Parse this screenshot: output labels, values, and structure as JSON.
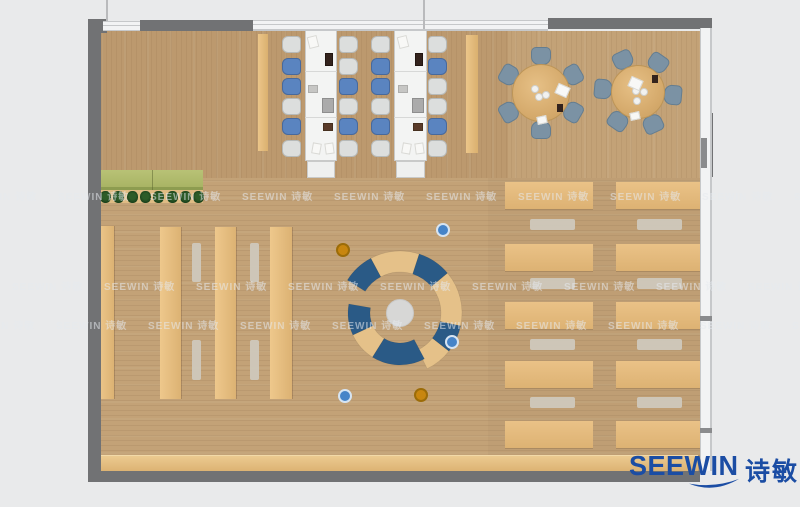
{
  "logo": {
    "en": "SEEWIN",
    "cn": "诗敏",
    "color": "#1b4da4"
  },
  "watermark": {
    "text": "SEEWIN 诗敏",
    "color": "rgba(230,233,238,0.55)",
    "step": 92,
    "rows": [
      {
        "y": 188,
        "x0": -34
      },
      {
        "y": 278,
        "x0": 12
      },
      {
        "y": 317,
        "x0": -36
      }
    ]
  },
  "palette": {
    "bg": "#e9eaeb",
    "wall": "#717274",
    "window": "#f2f3f4",
    "windowLine": "#c6c8ca",
    "floor": "#c3a277",
    "tanLight": "#eec88c",
    "tanDark": "#dcb273",
    "benchGray": "rgba(207,200,188,0.95)",
    "chairBlue": "#5a84c0",
    "chairBlueEdge": "#47699d",
    "chairGray": "#dcdedd",
    "chairGrayEdge": "#b7bab9",
    "slate": "#7b92a4",
    "slateEdge": "#647d90",
    "deskWhite": "#f3f4f3",
    "deskEdge": "#c9cac9",
    "arcBlue": "#2a5a86",
    "arcTan": "#e5c189",
    "hub": "#d7d7d6",
    "planterGreen": "#a9b465",
    "planterDark": "#8d9c50",
    "plant": "#1c421c",
    "poufBlue": "#4684c8",
    "poufBlueRing": "#d6e4f2",
    "poufOrange": "#c8860f",
    "poufOrangeRing": "#9c6c08",
    "itemPaper": "#f8f8f6",
    "itemDark": "#33231d",
    "itemBrown": "#5a3b2a",
    "itemLaptop": "#ababab",
    "itemGray": "#c6c6c4"
  },
  "floor": {
    "x": 101,
    "y": 31,
    "w": 599,
    "h": 440,
    "topGrainH": 147,
    "darkTopLeftW": 407
  },
  "walls": [
    {
      "n": "wall-top-left-corner",
      "x": 88,
      "y": 19,
      "w": 19,
      "h": 14
    },
    {
      "n": "wall-top-beam",
      "x": 140,
      "y": 20,
      "w": 113,
      "h": 11
    },
    {
      "n": "wall-top-right-beam",
      "x": 548,
      "y": 18,
      "w": 164,
      "h": 11
    },
    {
      "n": "wall-left",
      "x": 88,
      "y": 22,
      "w": 13,
      "h": 460
    },
    {
      "n": "wall-bottom",
      "x": 88,
      "y": 471,
      "w": 612,
      "h": 11
    },
    {
      "n": "wall-right-pillar",
      "x": 700,
      "y": 113,
      "w": 13,
      "h": 64
    }
  ],
  "windows": [
    {
      "n": "window-top-gap",
      "x": 103,
      "y": 21,
      "w": 37,
      "h": 10,
      "dir": "h"
    },
    {
      "n": "window-top",
      "x": 253,
      "y": 20,
      "w": 295,
      "h": 11,
      "dir": "h"
    },
    {
      "n": "window-right",
      "x": 700,
      "y": 28,
      "w": 12,
      "h": 443,
      "dir": "v"
    }
  ],
  "mullions": [
    {
      "x": 106,
      "y": 0,
      "w": 2,
      "h": 21
    },
    {
      "x": 423,
      "y": 0,
      "w": 2,
      "h": 29
    }
  ],
  "wall_ticks": [
    {
      "x": 700,
      "y": 316,
      "w": 12,
      "h": 5
    },
    {
      "x": 700,
      "y": 428,
      "w": 12,
      "h": 5
    },
    {
      "x": 701,
      "y": 138,
      "w": 6,
      "h": 30
    }
  ],
  "planter": {
    "x": 100,
    "y": 170,
    "w": 103,
    "h": 17,
    "bandH": 4,
    "shelfY": 190,
    "shelfH": 13,
    "plantY": 191,
    "plantX0": 100,
    "plantStep": 13.3,
    "plantN": 8,
    "plantW": 11,
    "plantH": 12
  },
  "stacks": {
    "cols": [
      [
        98,
        226,
        16,
        173
      ],
      [
        160,
        227,
        21,
        172
      ],
      [
        215,
        227,
        21,
        172
      ],
      [
        270,
        227,
        22,
        172
      ]
    ],
    "benches": [
      [
        192,
        243,
        9,
        39
      ],
      [
        192,
        340,
        9,
        40
      ],
      [
        250,
        243,
        9,
        39
      ],
      [
        250,
        340,
        9,
        40
      ]
    ]
  },
  "flank_strips": [
    [
      258,
      34,
      10,
      117
    ],
    [
      466,
      35,
      12,
      118
    ]
  ],
  "study_desks": [
    {
      "x": 305,
      "y": 29,
      "w": 32,
      "h": 132,
      "dividers": [
        42,
        88
      ],
      "left_x": 282,
      "right_x": 339,
      "chair_ys": [
        36,
        58,
        78,
        98,
        118,
        140
      ],
      "left": [
        "g",
        "b",
        "b",
        "g",
        "b",
        "g"
      ],
      "right": [
        "g",
        "g",
        "b",
        "g",
        "b",
        "g"
      ],
      "items": [
        [
          "paper",
          3,
          7,
          10,
          12,
          -14
        ],
        [
          "dark",
          20,
          24,
          8,
          13,
          0
        ],
        [
          "gray",
          3,
          56,
          10,
          8,
          0
        ],
        [
          "laptop",
          17,
          69,
          12,
          15,
          0
        ],
        [
          "brown",
          18,
          94,
          10,
          8,
          0
        ],
        [
          "paper",
          7,
          114,
          9,
          11,
          10
        ],
        [
          "paper",
          20,
          114,
          9,
          11,
          -8
        ]
      ]
    },
    {
      "x": 394,
      "y": 29,
      "w": 33,
      "h": 132,
      "dividers": [
        42,
        88
      ],
      "left_x": 371,
      "right_x": 428,
      "chair_ys": [
        36,
        58,
        78,
        98,
        118,
        140
      ],
      "left": [
        "g",
        "b",
        "b",
        "g",
        "b",
        "g"
      ],
      "right": [
        "g",
        "b",
        "g",
        "g",
        "b",
        "g"
      ],
      "items": [
        [
          "paper",
          4,
          7,
          10,
          12,
          -14
        ],
        [
          "dark",
          21,
          24,
          8,
          13,
          0
        ],
        [
          "gray",
          4,
          56,
          10,
          8,
          0
        ],
        [
          "laptop",
          18,
          69,
          12,
          15,
          0
        ],
        [
          "brown",
          19,
          94,
          10,
          8,
          0
        ],
        [
          "paper",
          8,
          114,
          9,
          11,
          10
        ],
        [
          "paper",
          21,
          114,
          9,
          11,
          -8
        ]
      ]
    }
  ],
  "round_tables": [
    {
      "cx": 541,
      "cy": 93,
      "r": 29,
      "chairR": 37,
      "angles": [
        -90,
        -150,
        150,
        90,
        30,
        -30
      ],
      "items": [
        [
          "plate",
          -6,
          -4
        ],
        [
          "plate",
          -2,
          4
        ],
        [
          "plate",
          5,
          2
        ],
        [
          "paper",
          15,
          -8
        ],
        [
          "dark",
          16,
          11
        ],
        [
          "paper2",
          -4,
          23
        ]
      ]
    },
    {
      "cx": 638,
      "cy": 92,
      "r": 27,
      "chairR": 35,
      "angles": [
        -115,
        -55,
        5,
        65,
        125,
        185
      ],
      "items": [
        [
          "plate",
          -2,
          -1
        ],
        [
          "plate",
          6,
          0
        ],
        [
          "plate",
          -1,
          9
        ],
        [
          "paper",
          -9,
          -14
        ],
        [
          "dark",
          14,
          -17
        ],
        [
          "paper2",
          -8,
          20
        ]
      ]
    }
  ],
  "reading": {
    "cols": [
      {
        "x": 505,
        "w": 88,
        "bx": 530,
        "bw": 45
      },
      {
        "x": 616,
        "w": 84,
        "bx": 637,
        "bw": 45
      }
    ],
    "desk_ys": [
      182,
      244,
      302,
      361,
      421
    ],
    "desk_h": 27,
    "bench_ys": [
      219,
      278,
      339,
      397
    ],
    "bench_h": 11
  },
  "counter": {
    "x": 100,
    "y": 455,
    "w": 598,
    "h": 16
  },
  "lounge": {
    "cx": 400,
    "cy": 313,
    "hubR": 14,
    "bands": [
      {
        "r0": 41,
        "r1": 62,
        "segs": [
          [
            -148,
            -118,
            "blue"
          ],
          [
            -118,
            -72,
            "tan"
          ],
          [
            -72,
            -40,
            "blue"
          ],
          [
            -40,
            12,
            "tan"
          ],
          [
            12,
            38,
            "blue"
          ],
          [
            38,
            64,
            "tan"
          ]
        ]
      },
      {
        "r0": 30,
        "r1": 52,
        "segs": [
          [
            62,
            122,
            "blue"
          ],
          [
            122,
            155,
            "tan"
          ],
          [
            155,
            190,
            "blue"
          ]
        ]
      }
    ],
    "poufR": 7,
    "poufs": [
      {
        "x": 343,
        "y": 250,
        "c": "orange"
      },
      {
        "x": 443,
        "y": 230,
        "c": "blue"
      },
      {
        "x": 452,
        "y": 342,
        "c": "blue"
      },
      {
        "x": 345,
        "y": 396,
        "c": "blue"
      },
      {
        "x": 421,
        "y": 395,
        "c": "orange"
      }
    ]
  }
}
